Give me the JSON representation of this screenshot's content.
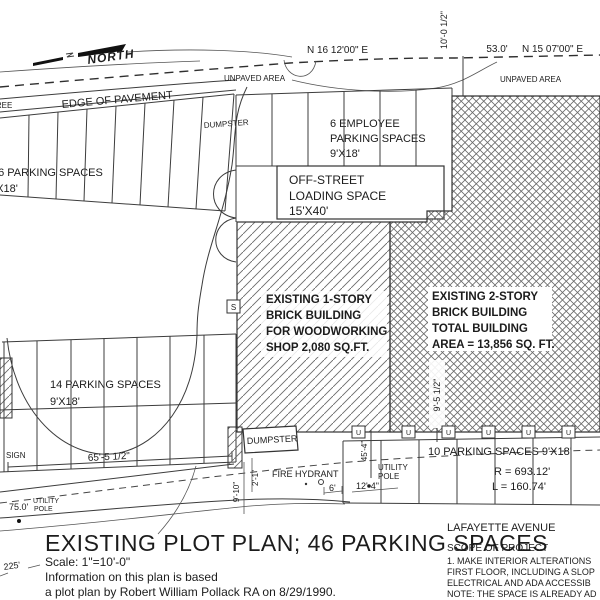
{
  "title_block": {
    "title": "EXISTING PLOT PLAN; 46 PARKING SPACES",
    "scale": "Scale: 1\"=10'-0\"",
    "note_line1": "Information on this plan is based",
    "note_line2": "a plot plan by Robert William Pollack RA on 8/29/1990."
  },
  "street": {
    "name": "LAFAYETTE AVENUE"
  },
  "scope": {
    "heading": "SCOPE OF PROJECT",
    "line1": "1. MAKE INTERIOR ALTERATIONS",
    "line2": "FIRST FLOOR, INCLUDING A SLOP",
    "line3": "ELECTRICAL AND ADA ACCESSIB",
    "line4": "NOTE: THE SPACE IS ALREADY AD"
  },
  "compass": {
    "label": "NORTH"
  },
  "survey": {
    "bearing_left": "N 16 12'00\" E",
    "bearing_right": "N 15 07'00\" E",
    "dim_53": "53.0'",
    "dim_10_0": "10'-0 1/2\""
  },
  "areas": {
    "unpaved_left": "UNPAVED AREA",
    "unpaved_right": "UNPAVED AREA",
    "edge_of_pavement": "EDGE OF PAVEMENT",
    "tree": "TREE"
  },
  "parking": {
    "north_row": {
      "label": "16 PARKING SPACES",
      "size": "9'X18'"
    },
    "employee": {
      "line1": "6 EMPLOYEE",
      "line2": "PARKING SPACES",
      "line3": "9'X18'"
    },
    "west": {
      "label": "14 PARKING SPACES",
      "size": "9'X18'"
    },
    "south": {
      "label": "10 PARKING SPACES 9'X18'",
      "radius": "R = 693.12'",
      "length": "L = 160.74'",
      "u_marker": "U"
    }
  },
  "loading": {
    "line1": "OFF-STREET",
    "line2": "LOADING SPACE",
    "line3": "15'X40'"
  },
  "buildings": {
    "one_story": {
      "line1": "EXISTING 1-STORY",
      "line2": "BRICK BUILDING",
      "line3": "FOR WOODWORKING",
      "line4": "SHOP 2,080 SQ.FT."
    },
    "two_story": {
      "line1": "EXISTING 2-STORY",
      "line2": "BRICK BUILDING",
      "line3": "TOTAL BUILDING",
      "line4": "AREA = 13,856 SQ. FT."
    }
  },
  "site_features": {
    "dumpster_top": "DUMPSTER",
    "dumpster_bottom": "DUMPSTER",
    "fire_hydrant": "FIRE HYDRANT",
    "sign": "SIGN",
    "s_marker": "S",
    "utility_pole_mid": {
      "line1": "UTILITY",
      "line2": "POLE"
    },
    "utility_pole_left": {
      "line1": "UTILITY",
      "line2": "POLE"
    }
  },
  "dimensions": {
    "d65": "65'-5 1/2\"",
    "d75": "75.0'",
    "d225": "225'",
    "d45": "45'-4\"",
    "d12": "12'-4\"",
    "d9_10": "9'-10\"",
    "d2_1": "2'-1\"",
    "d6": "6'",
    "d9_5": "9'-5 1/2\""
  },
  "colors": {
    "ink": "#1c1c1c",
    "hatch": "#6a6a6a",
    "paper": "#ffffff"
  }
}
